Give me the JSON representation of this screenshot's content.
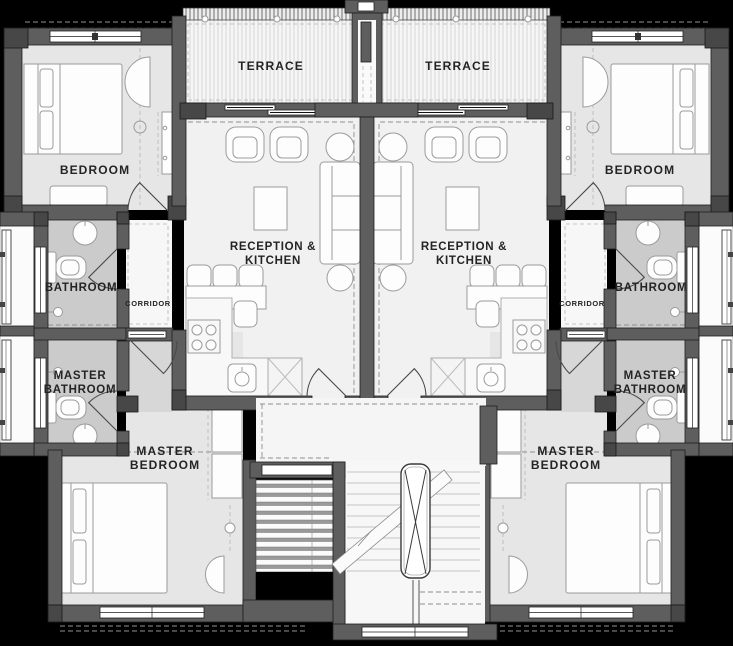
{
  "plan": {
    "type": "residential-floor-plan",
    "units": [
      "left-apartment",
      "right-apartment"
    ],
    "rooms": {
      "terrace": {
        "label": "TERRACE"
      },
      "bedroom": {
        "label": "BEDROOM"
      },
      "reception": {
        "label_line1": "RECEPTION &",
        "label_line2": "KITCHEN"
      },
      "bathroom": {
        "label": "BATHROOM"
      },
      "corridor": {
        "label": "CORRIDOR"
      },
      "master_bathroom": {
        "label_line1": "MASTER",
        "label_line2": "BATHROOM"
      },
      "master_bedroom": {
        "label_line1": "MASTER",
        "label_line2": "BEDROOM"
      }
    },
    "colors": {
      "background": "#000000",
      "wall": "#5e5e5e",
      "wall_dark": "#474747",
      "floor_room": "#e6e6e6",
      "floor_reception": "#f1f1f1",
      "floor_bath": "#cbcbcb",
      "floor_passage": "#d7d7d7",
      "label_text": "#242424"
    }
  }
}
